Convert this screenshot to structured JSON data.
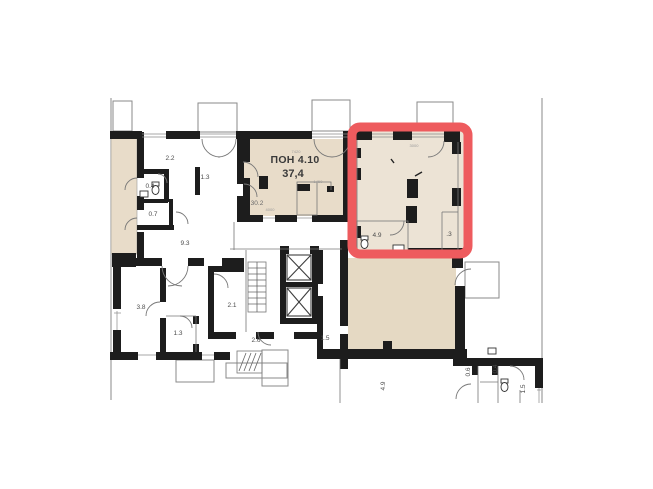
{
  "document": {
    "type": "apartment-floor-plan"
  },
  "colors": {
    "highlight_red": "#ee5b5e",
    "wall_black": "#1d1d1d",
    "fill_beige": "#e8dcc9",
    "fill_beige_light": "#ece3d5",
    "fill_beige_dark": "#e5d9c3",
    "line_gray": "#8a8a8a"
  },
  "pon_unit": {
    "name": "ПОН 4.10",
    "area": "37,4",
    "sub_area": "30.2"
  },
  "highlight_unit": {
    "wc_area": "4.9",
    "partial_label": ".3",
    "dim_top": "3000"
  },
  "rooms": {
    "room_2_2": "2.2",
    "hall_1_3": "1.3",
    "wc_0_4": "0.4",
    "bath_0_7": "0.7",
    "corridor_9_3": "9.3",
    "room_3_8": "3.8",
    "hall_1_3b": "1.3",
    "stair_hall_2_1": "2.1",
    "lobby_2_6": "2.6",
    "lift_hall_1_5": "1.5",
    "corridor_4_9": "4.9",
    "hall_0_6": "0.6",
    "wc_0_4b": "0.4",
    "hall_1_5b": "1.5"
  },
  "dimensions": {
    "pon_width": "7420",
    "pon_door": "1450",
    "pon_inner": "4000"
  }
}
